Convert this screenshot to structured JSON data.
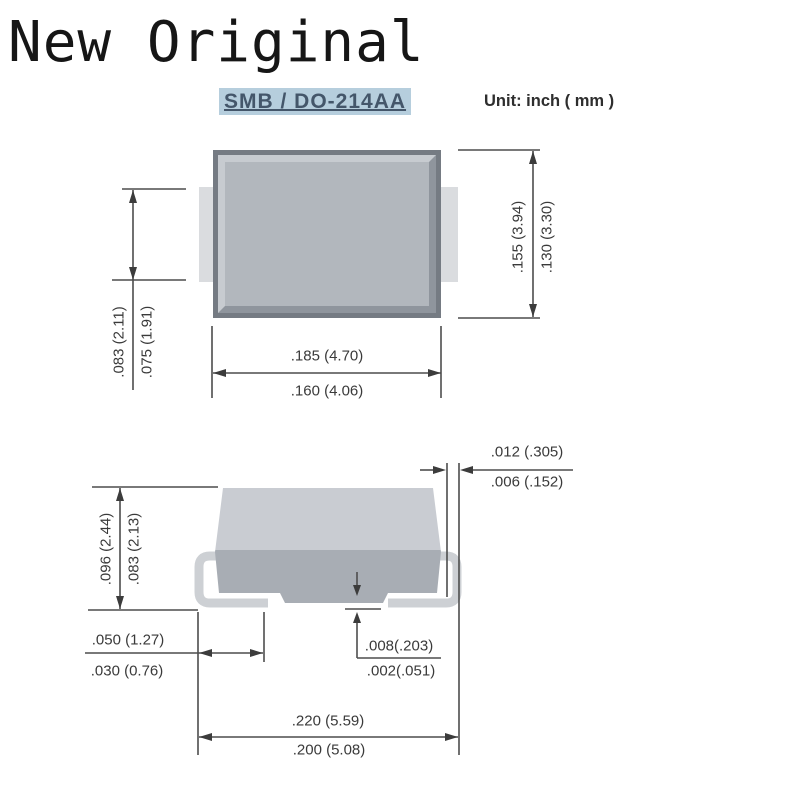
{
  "page": {
    "watermark": "New Original",
    "package_title": "SMB / DO-214AA",
    "unit_note": "Unit: inch ( mm )"
  },
  "colors": {
    "title_highlight": "#b6cedd",
    "title_text": "#44566a",
    "body_frame": "#757b83",
    "body_fill": "#b2b7bd",
    "bevel_light": "#c7cbd0",
    "bevel_dark": "#8f959d",
    "tab_fill": "#dadcdf",
    "lead_fill": "#cdd0d4",
    "side_body_top": "#c9ccd2",
    "side_body_bottom": "#a8adb4",
    "dim_line": "#4d4d4d",
    "dim_text": "#3a3a3a"
  },
  "top_view": {
    "dims": {
      "terminal_width": {
        "max": ".083 (2.11)",
        "min": ".075 (1.91)"
      },
      "body_width": {
        "max": ".185 (4.70)",
        "min": ".160 (4.06)"
      },
      "body_height": {
        "max": ".155 (3.94)",
        "min": ".130 (3.30)"
      }
    }
  },
  "side_view": {
    "dims": {
      "lead_thickness": {
        "max": ".012 (.305)",
        "min": ".006 (.152)"
      },
      "body_thickness": {
        "max": ".096 (2.44)",
        "min": ".083 (2.13)"
      },
      "terminal_length": {
        "max": ".050 (1.27)",
        "min": ".030 (0.76)"
      },
      "standoff": {
        "max": ".008(.203)",
        "min": ".002(.051)"
      },
      "overall_width": {
        "max": ".220 (5.59)",
        "min": ".200 (5.08)"
      }
    }
  }
}
